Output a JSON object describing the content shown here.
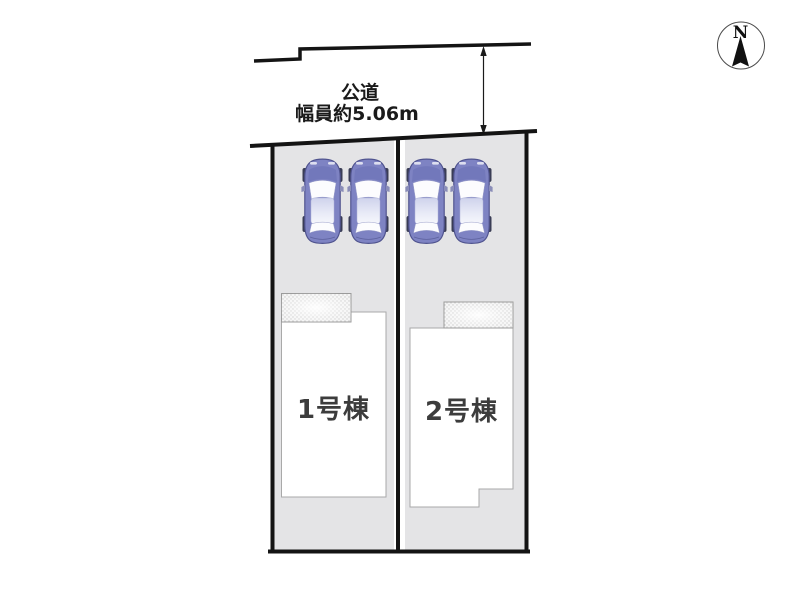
{
  "diagram_title": "分譲区画図",
  "road": {
    "name_label": "公道",
    "width_label": "幅員約5.06m",
    "width_m": "5.06"
  },
  "compass": {
    "label": "N",
    "direction": "up"
  },
  "units": [
    {
      "id": 1,
      "label": "1号棟",
      "parked_cars": 2
    },
    {
      "id": 2,
      "label": "2号棟",
      "parked_cars": 2
    }
  ],
  "colors": {
    "plot_fill": "#e4e4e6",
    "outline": "#141414",
    "building_fill": "#ffffff",
    "building_border": "#a9a9a9",
    "car_body": "#7e83c3",
    "car_dark": "#50548f",
    "text": "#1a1a1a",
    "unit_text": "#3c3c3c"
  }
}
